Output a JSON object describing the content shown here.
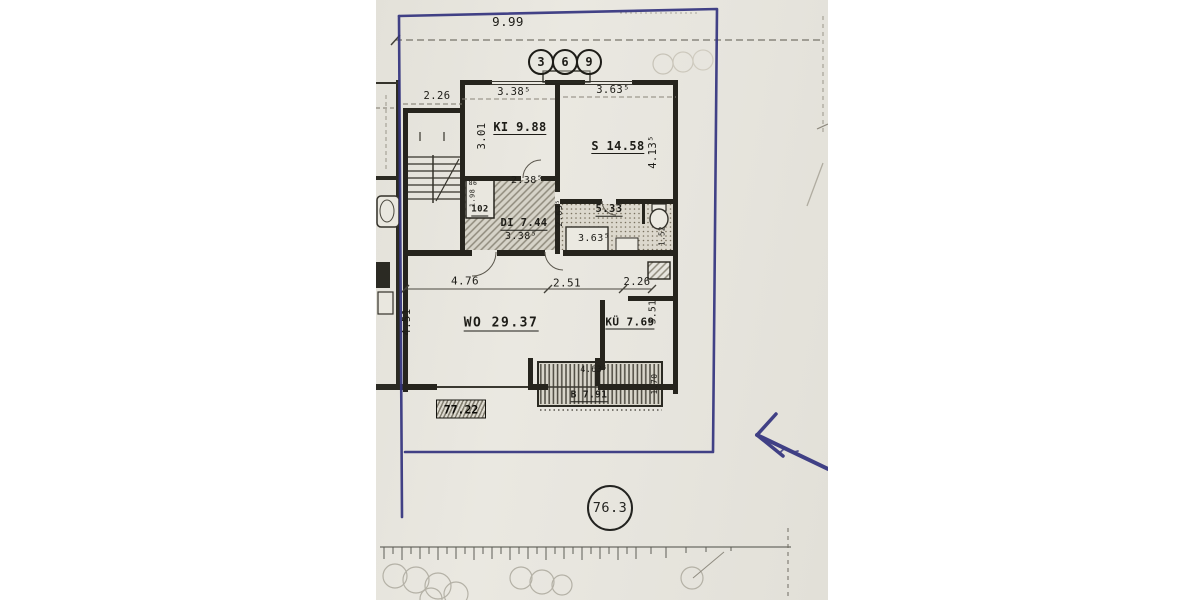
{
  "floorplan": {
    "overall_width_dim": "9.99",
    "axis_markers": [
      "3",
      "6",
      "9"
    ],
    "stairwell_dim": "2.26",
    "ki": {
      "label": "KI 9.88",
      "width_dim": "3.38⁵",
      "height_dim": "3.01"
    },
    "s": {
      "label": "S 14.58",
      "width_dim": "3.63⁵",
      "height_dim": "4.13⁵"
    },
    "hall": {
      "label": "DI 7.44",
      "top_dim": "2.38⁵",
      "width_dim": "3.38⁵",
      "height_dim": "2.63⁵"
    },
    "closet": {
      "label": "102",
      "top_dim": "86",
      "height_dim": "1.98"
    },
    "bath": {
      "label": "5.33",
      "width_dim": "3.63⁵"
    },
    "wc": {
      "width_dim": "1.52"
    },
    "wo": {
      "label": "WO 29.37",
      "seg1_dim": "4.76",
      "seg2_dim": "2.51",
      "seg3_dim": "2.26",
      "height_dim": "4.51"
    },
    "kitchen": {
      "label": "KÜ 7.69",
      "height_dim": "3.51"
    },
    "balcony": {
      "label": "B 7.91",
      "width_dim": "4.63⁵",
      "depth_dim": "1.70"
    },
    "total_area": "77.22",
    "site_marker": "76.3"
  }
}
